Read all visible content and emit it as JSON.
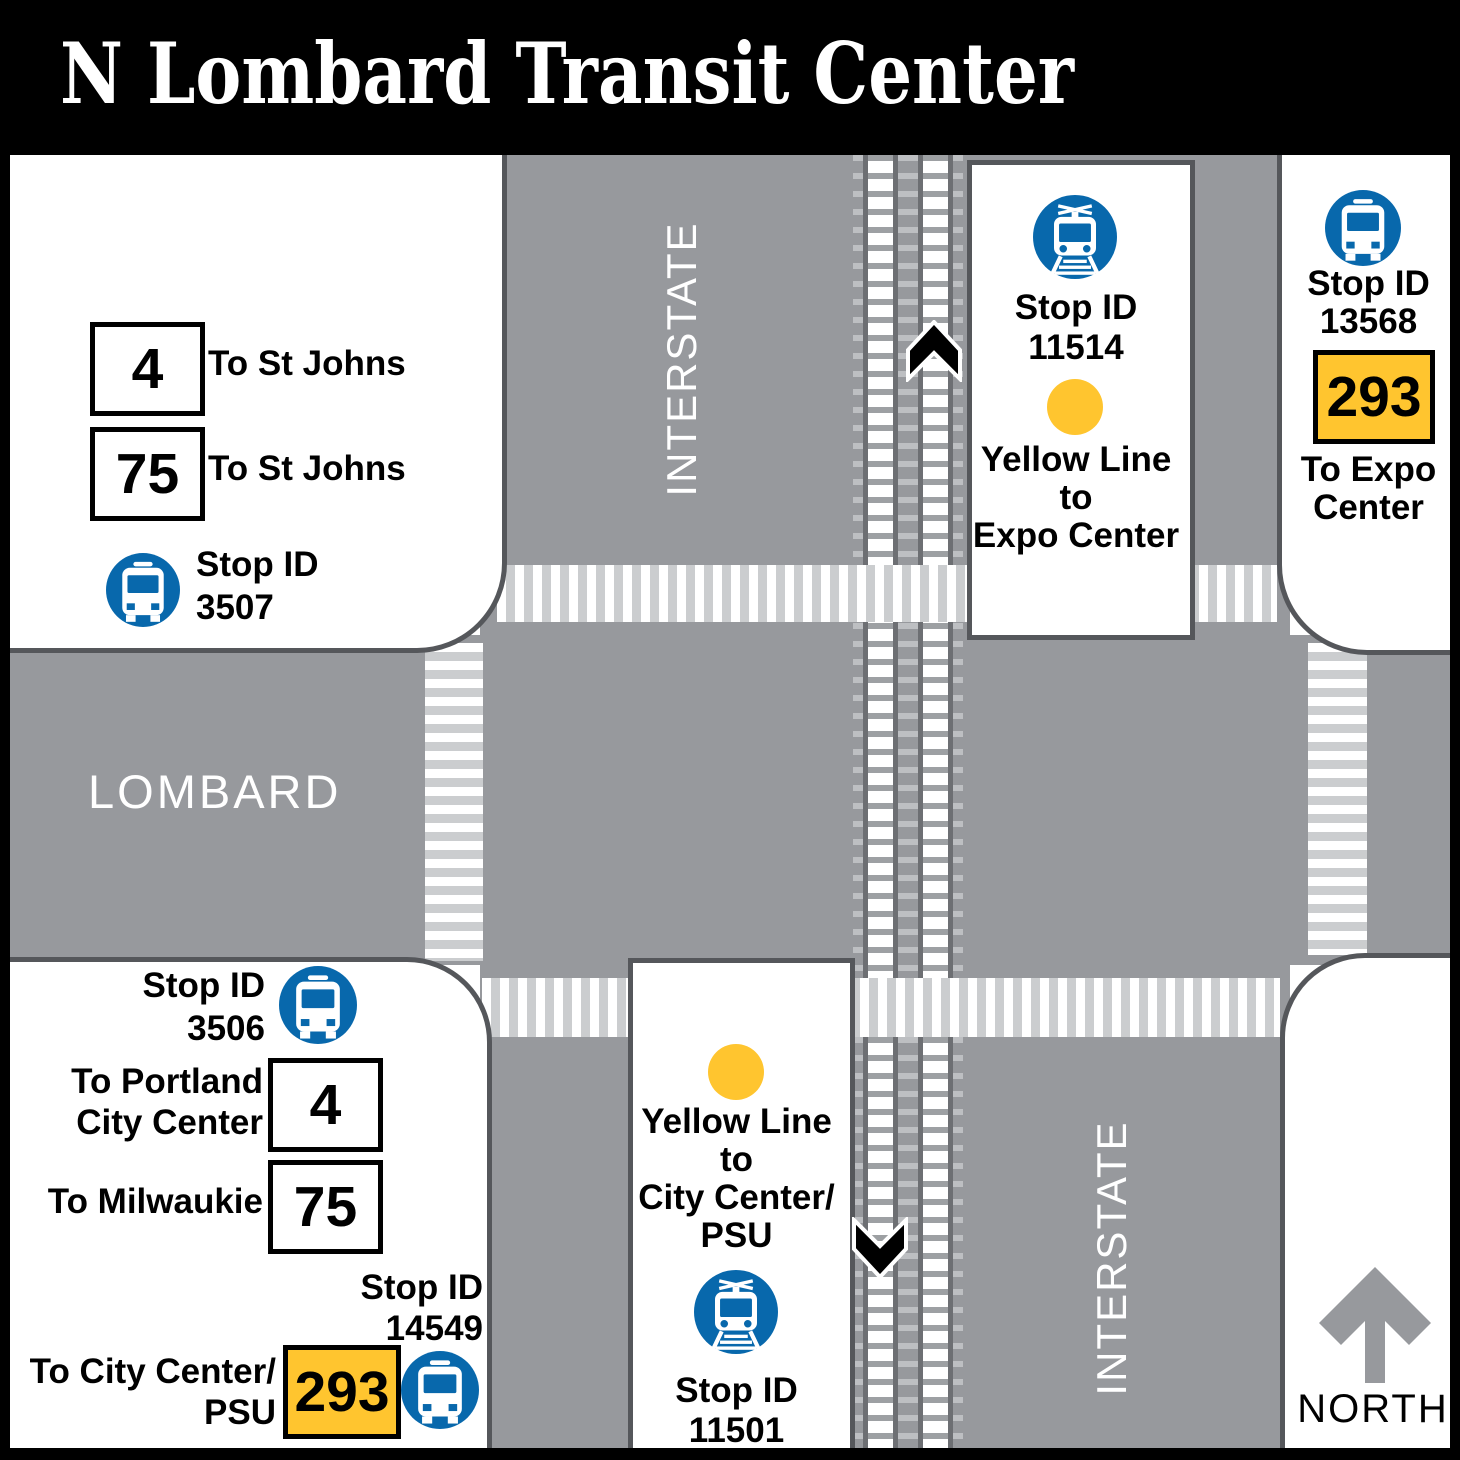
{
  "header": {
    "title": "N Lombard Transit Center"
  },
  "streets": {
    "interstate_north": "INTERSTATE",
    "interstate_south": "INTERSTATE",
    "lombard": "LOMBARD"
  },
  "compass": {
    "north_label": "NORTH"
  },
  "colors": {
    "brand_blue": "#0868AC",
    "yellow_line": "#FFC52F",
    "road_gray": "#97999D",
    "crosswalk_gray": "#CBCDCF",
    "outline_gray": "#55575B",
    "rail_gray": "#6D6F73"
  },
  "icons": {
    "bus": "bus-front-icon",
    "rail": "light-rail-icon",
    "yellow_dot": "yellow-line-stop-dot",
    "north": "north-arrow-icon",
    "up": "track-direction-up-chevron",
    "down": "track-direction-down-chevron"
  },
  "stops": {
    "nw": {
      "route_4": "4",
      "route_4_dest": "To St Johns",
      "route_75": "75",
      "route_75_dest": "To St Johns",
      "stop_id_label": "Stop ID",
      "stop_id": "3507"
    },
    "platform_north": {
      "stop_id_label": "Stop ID",
      "stop_id": "11514",
      "line_l1": "Yellow Line",
      "line_l2": "to",
      "line_l3": "Expo Center"
    },
    "ne": {
      "stop_id_label": "Stop ID",
      "stop_id": "13568",
      "route": "293",
      "dest_l1": "To Expo",
      "dest_l2": "Center"
    },
    "sw": {
      "stop1_id_label": "Stop ID",
      "stop1_id": "3506",
      "route_4": "4",
      "route_4_dest_l1": "To Portland",
      "route_4_dest_l2": "City Center",
      "route_75": "75",
      "route_75_dest": "To Milwaukie",
      "stop2_id_label": "Stop ID",
      "stop2_id": "14549",
      "route_293": "293",
      "route_293_dest_l1": "To City Center/",
      "route_293_dest_l2": "PSU"
    },
    "platform_south": {
      "line_l1": "Yellow Line",
      "line_l2": "to",
      "line_l3": "City Center/",
      "line_l4": "PSU",
      "stop_id_label": "Stop ID",
      "stop_id": "11501"
    }
  }
}
